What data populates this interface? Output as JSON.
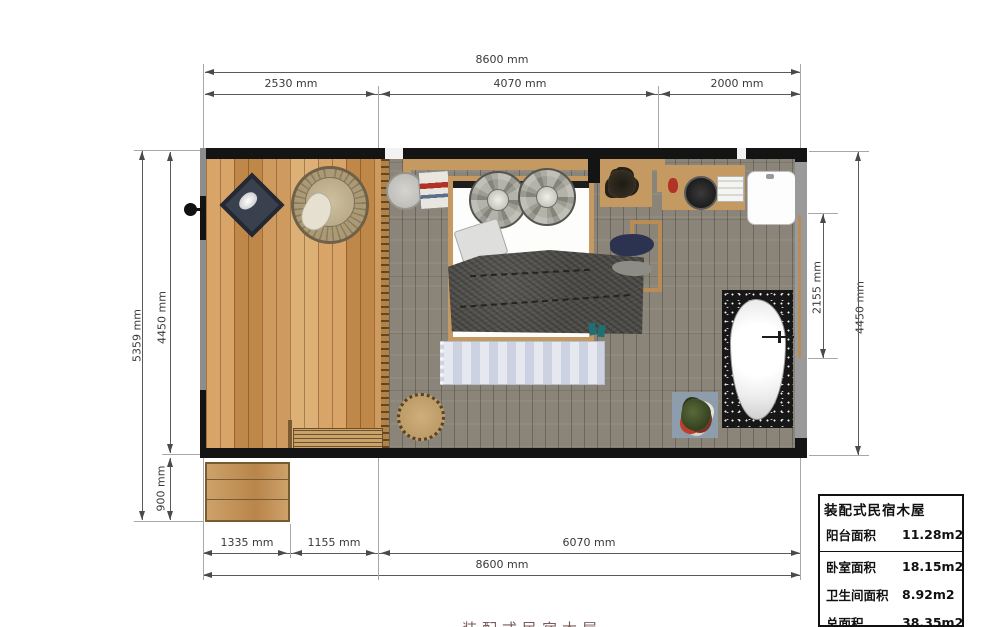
{
  "drawing": {
    "caption_partial": "装配式民宿木屋"
  },
  "dimensions": {
    "top_total": "8600 mm",
    "top_segments": [
      "2530 mm",
      "4070 mm",
      "2000 mm"
    ],
    "left_total": "5359 mm",
    "left_upper": "4450 mm",
    "left_lower": "900 mm",
    "right_outer": "4450 mm",
    "right_inner": "2155 mm",
    "bottom_segments": [
      "1335 mm",
      "1155 mm",
      "6070 mm"
    ],
    "bottom_total": "8600 mm"
  },
  "area_table": {
    "title": "装配式民宿木屋",
    "rows": [
      {
        "label": "阳台面积",
        "value": "11.28m2"
      },
      {
        "label": "卧室面积",
        "value": "18.15m2"
      },
      {
        "label": "卫生间面积",
        "value": "8.92m2"
      },
      {
        "label": "总面积",
        "value": "38.35m2"
      }
    ]
  },
  "colors": {
    "wall": "#141414",
    "deck_wood": "#cf9a5e",
    "room_floor": "#8b8478",
    "wood_accent": "#c49a62",
    "duvet": "#4e4d49",
    "rug": "#ccd2e2",
    "tub_mat": "#171717",
    "accent_red": "#b03326",
    "teal": "#1f6f74",
    "dim_text": "#3a3a3a"
  }
}
